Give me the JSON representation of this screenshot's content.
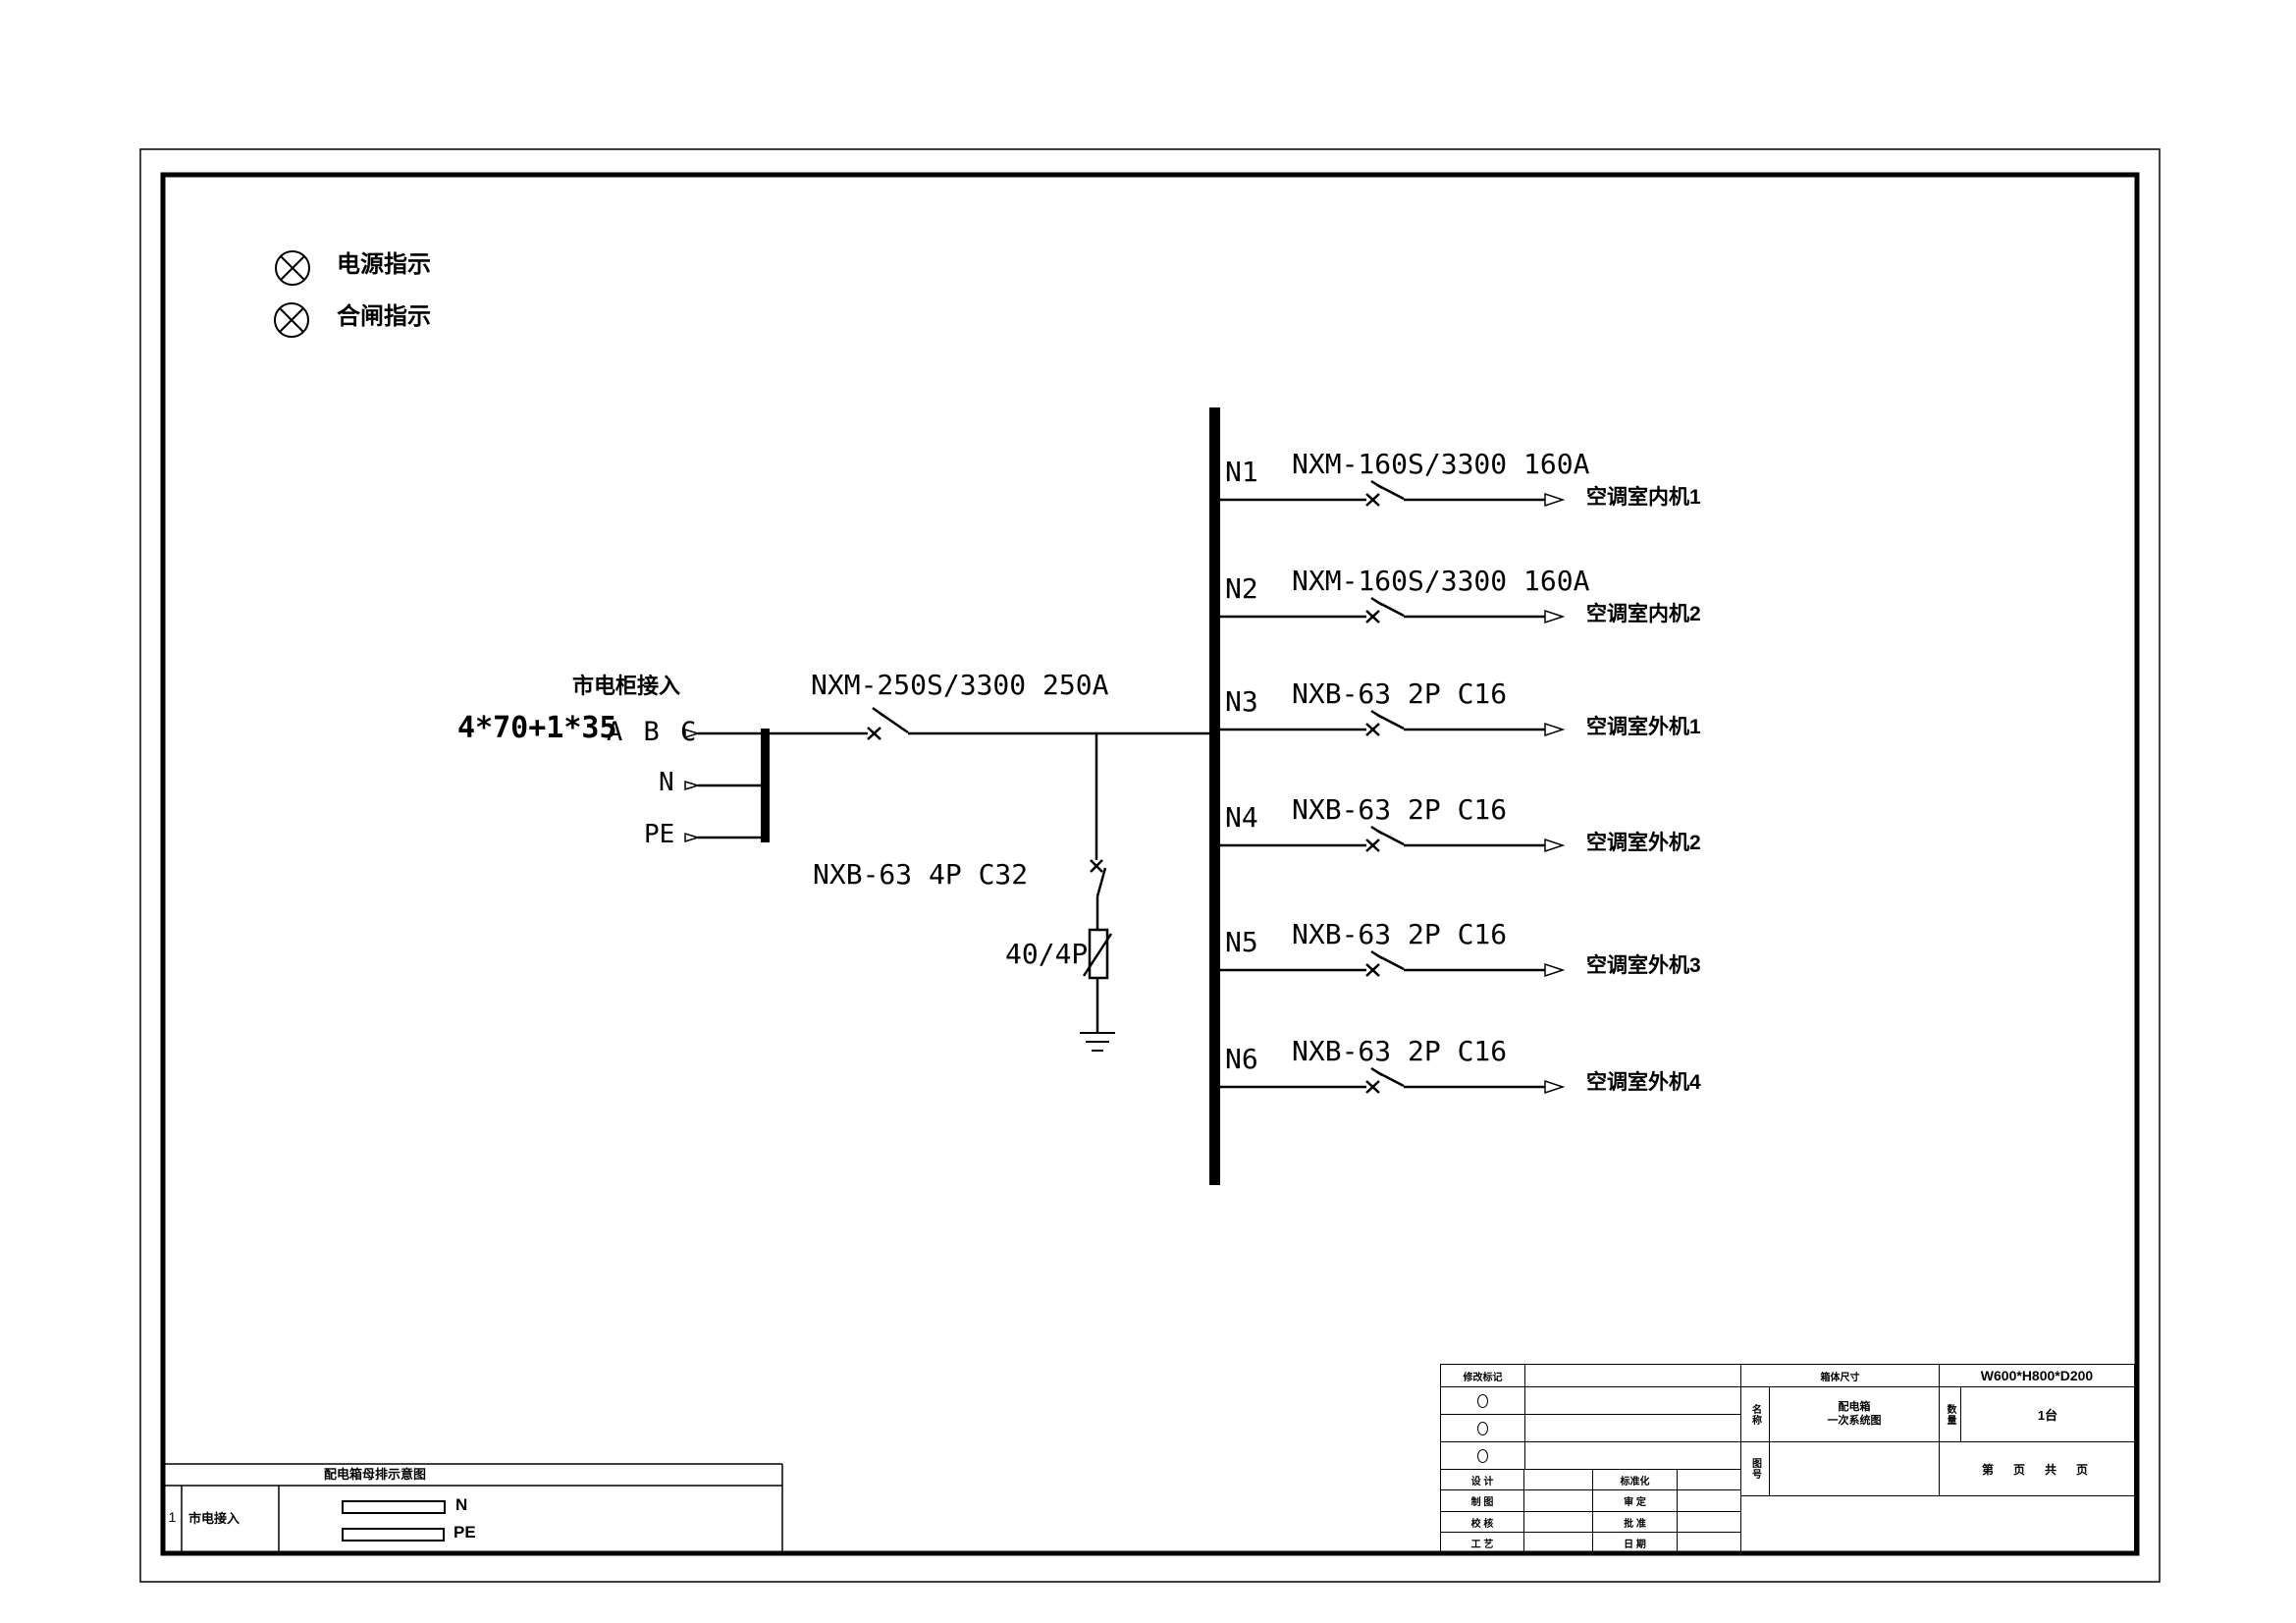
{
  "indicators": [
    {
      "icon": "lamp-icon",
      "label": "电源指示"
    },
    {
      "icon": "lamp-icon",
      "label": "合闸指示"
    }
  ],
  "incoming": {
    "source_label": "市电柜接入",
    "cable": "4*70+1*35",
    "phase_label": "A B C",
    "neutral_label": "N",
    "pe_label": "PE"
  },
  "main_breaker": {
    "model": "NXM-250S/3300 250A"
  },
  "surge": {
    "breaker": "NXB-63 4P C32",
    "arrester": "40/4P"
  },
  "branches": [
    {
      "id": "N1",
      "breaker": "NXM-160S/3300 160A",
      "load": "空调室内机1"
    },
    {
      "id": "N2",
      "breaker": "NXM-160S/3300 160A",
      "load": "空调室内机2"
    },
    {
      "id": "N3",
      "breaker": "NXB-63 2P C16",
      "load": "空调室外机1"
    },
    {
      "id": "N4",
      "breaker": "NXB-63 2P C16",
      "load": "空调室外机2"
    },
    {
      "id": "N5",
      "breaker": "NXB-63 2P C16",
      "load": "空调室外机3"
    },
    {
      "id": "N6",
      "breaker": "NXB-63 2P C16",
      "load": "空调室外机4"
    }
  ],
  "legend_table": {
    "title": "配电箱母排示意图",
    "row_no": "1",
    "row_label": "市电接入",
    "bars": [
      {
        "label": "N"
      },
      {
        "label": "PE"
      }
    ]
  },
  "title_block": {
    "revision_header": "修改标记",
    "size_header": "箱体尺寸",
    "size_value": "W600*H800*D200",
    "name_label": "名称",
    "name_line1": "配电箱",
    "name_line2": "一次系统图",
    "qty_label": "数量",
    "qty_value": "1台",
    "fig_label": "图号",
    "page_text": "第　页　共　页",
    "rows": [
      {
        "l1": "设 计",
        "l2": "标准化"
      },
      {
        "l1": "制 图",
        "l2": "审 定"
      },
      {
        "l1": "校 核",
        "l2": "批 准"
      },
      {
        "l1": "工 艺",
        "l2": "日 期"
      }
    ]
  }
}
